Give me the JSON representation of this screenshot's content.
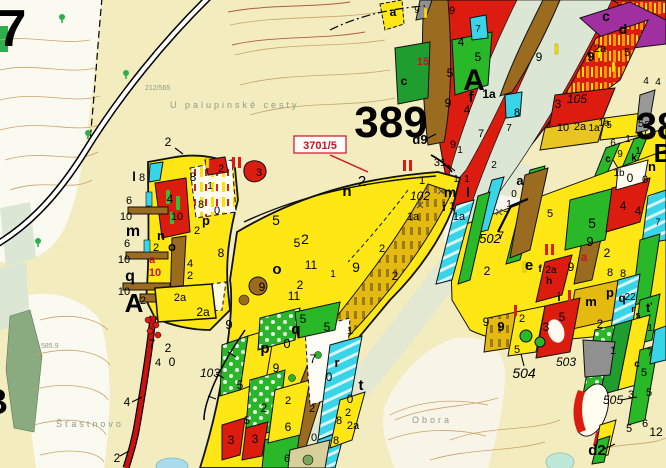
{
  "map": {
    "type": "forestry-stand-map",
    "palette": {
      "paper_cream": "#f2ecbe",
      "paper_white": "#fbfaf1",
      "stand_yellow": "#ffe715",
      "stand_gold": "#e5ba10",
      "stand_green": "#2ab52a",
      "stand_darkgreen": "#1f9e2f",
      "stand_red": "#dd1c10",
      "stand_brown": "#9b6c1f",
      "stand_cyan": "#38d4e8",
      "stand_purple": "#a02fa0",
      "stand_gray": "#909090",
      "meadow_band": "#dce6d4",
      "contour": "#c9a36a",
      "contour_index": "#b25b40",
      "label_red": "#cc1122",
      "label_gray": "#8d9c85"
    },
    "parcel_callout": {
      "text": "3701/5",
      "x": 294,
      "y": 136,
      "w": 52,
      "h": 17
    },
    "compartment_numbers": [
      "7",
      "389",
      "38"
    ],
    "stand_group_letters": [
      "A",
      "B"
    ],
    "place_names": [
      "U palupinské cesty",
      "Šťastnovo",
      "Obora"
    ],
    "road_numbers": [
      "102",
      "103",
      "105",
      "502",
      "503",
      "504",
      "505"
    ],
    "elevation_points": [
      "212/565",
      "585.9"
    ],
    "labels": [
      [
        "7",
        12,
        46,
        52,
        "b"
      ],
      [
        "389",
        391,
        137,
        44,
        "b"
      ],
      [
        "38",
        657,
        139,
        38,
        "b"
      ],
      [
        "B",
        663,
        162,
        26,
        "b"
      ],
      [
        "A",
        474,
        90,
        30,
        "b"
      ],
      [
        "f",
        471,
        102,
        15,
        "b"
      ],
      [
        "4",
        467,
        114,
        12,
        ""
      ],
      [
        "A",
        134,
        312,
        26,
        "b"
      ],
      [
        "B",
        -5,
        414,
        36,
        "b"
      ],
      [
        "a",
        393,
        16,
        12,
        "b"
      ],
      [
        "c",
        606,
        21,
        14,
        "b"
      ],
      [
        "d",
        623,
        34,
        14,
        "b"
      ],
      [
        "d9",
        420,
        144,
        13,
        "b"
      ],
      [
        "d2",
        597,
        455,
        15,
        "b"
      ],
      [
        "c",
        404,
        85,
        12,
        "b"
      ],
      [
        "15",
        423,
        65,
        11,
        "br"
      ],
      [
        "9",
        417,
        13,
        10,
        ""
      ],
      [
        "9",
        452,
        14,
        11,
        ""
      ],
      [
        "4",
        461,
        46,
        12,
        ""
      ],
      [
        "7",
        478,
        32,
        10,
        ""
      ],
      [
        "5",
        478,
        61,
        12,
        ""
      ],
      [
        "5",
        450,
        77,
        12,
        ""
      ],
      [
        "9",
        448,
        107,
        12,
        ""
      ],
      [
        "1a",
        489,
        98,
        12,
        "b"
      ],
      [
        "8",
        517,
        116,
        11,
        ""
      ],
      [
        "7",
        481,
        137,
        11,
        ""
      ],
      [
        "7",
        509,
        131,
        10,
        ""
      ],
      [
        "9",
        539,
        61,
        12,
        ""
      ],
      [
        "9",
        591,
        61,
        13,
        "b"
      ],
      [
        "3",
        558,
        108,
        12,
        ""
      ],
      [
        "105",
        577,
        103,
        12,
        "i"
      ],
      [
        "10",
        563,
        131,
        11,
        ""
      ],
      [
        "2a",
        580,
        130,
        11,
        ""
      ],
      [
        "1a",
        594,
        131,
        10,
        ""
      ],
      [
        "5",
        609,
        128,
        10,
        ""
      ],
      [
        "2a",
        600,
        52,
        11,
        ""
      ],
      [
        "5",
        627,
        56,
        11,
        ""
      ],
      [
        "5a",
        644,
        127,
        11,
        ""
      ],
      [
        "1a",
        604,
        126,
        10,
        ""
      ],
      [
        "4",
        646,
        84,
        10,
        ""
      ],
      [
        "4",
        658,
        85,
        10,
        ""
      ],
      [
        "1",
        628,
        142,
        10,
        ""
      ],
      [
        "6",
        613,
        146,
        10,
        ""
      ],
      [
        "1",
        638,
        154,
        10,
        ""
      ],
      [
        "9",
        620,
        157,
        10,
        ""
      ],
      [
        "k",
        634,
        161,
        10,
        "b"
      ],
      [
        "c",
        608,
        162,
        10,
        "b"
      ],
      [
        "1b",
        619,
        176,
        10,
        ""
      ],
      [
        "0",
        645,
        183,
        11,
        ""
      ],
      [
        "n",
        652,
        171,
        13,
        "b"
      ],
      [
        "0",
        630,
        182,
        12,
        ""
      ],
      [
        "7",
        658,
        225,
        9,
        ""
      ],
      [
        "l",
        134,
        181,
        13,
        "b"
      ],
      [
        "8",
        142,
        181,
        11,
        ""
      ],
      [
        "6",
        129,
        204,
        11,
        ""
      ],
      [
        "10",
        126,
        220,
        11,
        ""
      ],
      [
        "m",
        133,
        236,
        16,
        "b"
      ],
      [
        "6",
        127,
        247,
        11,
        ""
      ],
      [
        "10",
        124,
        263,
        11,
        ""
      ],
      [
        "q",
        130,
        281,
        16,
        "b"
      ],
      [
        "10",
        124,
        295,
        11,
        ""
      ],
      [
        "2",
        143,
        304,
        11,
        ""
      ],
      [
        "4",
        170,
        203,
        12,
        ""
      ],
      [
        "10",
        177,
        220,
        11,
        ""
      ],
      [
        "n",
        161,
        240,
        13,
        "b"
      ],
      [
        "2",
        156,
        251,
        11,
        ""
      ],
      [
        "o",
        172,
        251,
        13,
        "b"
      ],
      [
        "a",
        152,
        263,
        11,
        "br"
      ],
      [
        "10",
        155,
        276,
        11,
        "br"
      ],
      [
        "8",
        193,
        181,
        12,
        ""
      ],
      [
        "1",
        210,
        189,
        10,
        ""
      ],
      [
        "2",
        221,
        172,
        11,
        ""
      ],
      [
        "3",
        259,
        176,
        11,
        ""
      ],
      [
        "8",
        201,
        208,
        11,
        ""
      ],
      [
        "0",
        217,
        214,
        11,
        ""
      ],
      [
        "p",
        206,
        225,
        13,
        "b"
      ],
      [
        "2",
        197,
        234,
        11,
        ""
      ],
      [
        "8",
        221,
        257,
        12,
        ""
      ],
      [
        "4",
        190,
        267,
        11,
        ""
      ],
      [
        "2",
        190,
        279,
        11,
        ""
      ],
      [
        "2a",
        180,
        301,
        11,
        ""
      ],
      [
        "2a",
        203,
        316,
        12,
        ""
      ],
      [
        "2",
        168,
        146,
        12,
        ""
      ],
      [
        "n",
        347,
        196,
        15,
        "b"
      ],
      [
        "2",
        362,
        186,
        15,
        ""
      ],
      [
        "5",
        276,
        225,
        14,
        ""
      ],
      [
        "2",
        305,
        244,
        14,
        ""
      ],
      [
        "5",
        297,
        247,
        12,
        ""
      ],
      [
        "o",
        277,
        274,
        15,
        "b"
      ],
      [
        "11",
        311,
        269,
        12,
        ""
      ],
      [
        "9",
        356,
        272,
        14,
        ""
      ],
      [
        "1",
        333,
        277,
        10,
        ""
      ],
      [
        "2",
        300,
        289,
        12,
        ""
      ],
      [
        "11",
        294,
        300,
        12,
        ""
      ],
      [
        "9",
        262,
        291,
        12,
        ""
      ],
      [
        "2",
        382,
        252,
        11,
        ""
      ],
      [
        "2",
        395,
        280,
        12,
        ""
      ],
      [
        "1",
        422,
        184,
        11,
        ""
      ],
      [
        "102",
        420,
        200,
        12,
        "i"
      ],
      [
        "1a",
        413,
        220,
        11,
        ""
      ],
      [
        "1a",
        459,
        220,
        11,
        ""
      ],
      [
        "m",
        450,
        197,
        14,
        "b"
      ],
      [
        "l",
        468,
        197,
        14,
        "b"
      ],
      [
        "i",
        444,
        211,
        12,
        "b"
      ],
      [
        "1",
        452,
        209,
        10,
        ""
      ],
      [
        "1",
        456,
        182,
        10,
        ""
      ],
      [
        "1",
        467,
        182,
        10,
        ""
      ],
      [
        "9",
        453,
        148,
        11,
        ""
      ],
      [
        "1",
        460,
        153,
        10,
        ""
      ],
      [
        "31",
        440,
        166,
        11,
        ""
      ],
      [
        "2",
        494,
        168,
        10,
        ""
      ],
      [
        "a",
        520,
        185,
        13,
        "b"
      ],
      [
        "0",
        514,
        197,
        10,
        ""
      ],
      [
        "1",
        509,
        207,
        10,
        ""
      ],
      [
        "7",
        506,
        218,
        10,
        ""
      ],
      [
        "502",
        490,
        243,
        13,
        "i"
      ],
      [
        "7",
        501,
        239,
        11,
        ""
      ],
      [
        "2",
        487,
        275,
        12,
        ""
      ],
      [
        "9",
        486,
        326,
        12,
        ""
      ],
      [
        "5",
        517,
        353,
        11,
        ""
      ],
      [
        "e",
        529,
        270,
        15,
        "b"
      ],
      [
        "f",
        540,
        272,
        10,
        "b"
      ],
      [
        "2a",
        551,
        273,
        10,
        ""
      ],
      [
        "h",
        549,
        284,
        10,
        "b"
      ],
      [
        "a",
        584,
        261,
        12,
        "br"
      ],
      [
        "9",
        590,
        246,
        13,
        ""
      ],
      [
        "5",
        592,
        228,
        14,
        ""
      ],
      [
        "2",
        607,
        257,
        12,
        ""
      ],
      [
        "9",
        571,
        271,
        12,
        ""
      ],
      [
        "8",
        610,
        276,
        11,
        ""
      ],
      [
        "8",
        623,
        277,
        11,
        ""
      ],
      [
        "p",
        610,
        297,
        13,
        "b"
      ],
      [
        "q",
        622,
        302,
        12,
        "b"
      ],
      [
        "m",
        591,
        306,
        13,
        "b"
      ],
      [
        "22",
        630,
        300,
        10,
        ""
      ],
      [
        "i",
        559,
        301,
        12,
        "b"
      ],
      [
        "ť",
        649,
        312,
        13,
        "b"
      ],
      [
        "r",
        633,
        312,
        9,
        "b"
      ],
      [
        "s",
        638,
        318,
        9,
        "b"
      ],
      [
        "1",
        650,
        331,
        10,
        ""
      ],
      [
        "4",
        623,
        210,
        12,
        ""
      ],
      [
        "4",
        638,
        215,
        12,
        ""
      ],
      [
        "5",
        550,
        217,
        11,
        ""
      ],
      [
        "9",
        229,
        329,
        13,
        ""
      ],
      [
        "p",
        265,
        353,
        15,
        "b"
      ],
      [
        "0",
        287,
        348,
        13,
        ""
      ],
      [
        "q",
        296,
        334,
        15,
        "b"
      ],
      [
        "5",
        303,
        323,
        12,
        ""
      ],
      [
        "5",
        327,
        331,
        12,
        ""
      ],
      [
        "1",
        350,
        334,
        11,
        ""
      ],
      [
        "7",
        313,
        363,
        12,
        ""
      ],
      [
        "9",
        276,
        372,
        12,
        ""
      ],
      [
        "r",
        337,
        367,
        13,
        "b"
      ],
      [
        "0",
        329,
        381,
        12,
        ""
      ],
      [
        "t",
        361,
        390,
        15,
        "b"
      ],
      [
        "0",
        350,
        403,
        12,
        ""
      ],
      [
        "2",
        348,
        416,
        11,
        ""
      ],
      [
        "8",
        339,
        424,
        11,
        ""
      ],
      [
        "2a",
        353,
        429,
        11,
        ""
      ],
      [
        "8",
        336,
        444,
        11,
        ""
      ],
      [
        "0",
        314,
        441,
        11,
        ""
      ],
      [
        "2",
        288,
        404,
        11,
        ""
      ],
      [
        "2",
        312,
        412,
        11,
        ""
      ],
      [
        "5",
        240,
        389,
        12,
        ""
      ],
      [
        "2",
        264,
        412,
        12,
        ""
      ],
      [
        "5",
        247,
        424,
        11,
        ""
      ],
      [
        "3",
        231,
        444,
        12,
        ""
      ],
      [
        "3",
        255,
        443,
        12,
        ""
      ],
      [
        "6",
        288,
        431,
        12,
        ""
      ],
      [
        "6",
        287,
        462,
        11,
        ""
      ],
      [
        "103",
        210,
        377,
        12,
        "i"
      ],
      [
        "4",
        127,
        406,
        12,
        ""
      ],
      [
        "2",
        117,
        462,
        12,
        ""
      ],
      [
        "7",
        152,
        348,
        12,
        ""
      ],
      [
        "2",
        168,
        352,
        12,
        ""
      ],
      [
        "0",
        172,
        366,
        12,
        ""
      ],
      [
        "4",
        158,
        366,
        11,
        ""
      ],
      [
        "9",
        501,
        331,
        13,
        "b"
      ],
      [
        "3",
        546,
        331,
        12,
        ""
      ],
      [
        "5",
        562,
        321,
        12,
        ""
      ],
      [
        "2",
        600,
        328,
        12,
        ""
      ],
      [
        "2",
        522,
        322,
        11,
        ""
      ],
      [
        "504",
        524,
        378,
        14,
        "i"
      ],
      [
        "503",
        566,
        366,
        12,
        "i"
      ],
      [
        "505",
        613,
        404,
        12,
        "i"
      ],
      [
        "12",
        656,
        436,
        12,
        ""
      ],
      [
        "7",
        650,
        356,
        11,
        ""
      ],
      [
        "5",
        644,
        376,
        11,
        ""
      ],
      [
        "c",
        637,
        367,
        10,
        "b"
      ],
      [
        "5",
        649,
        396,
        11,
        ""
      ],
      [
        "3",
        631,
        398,
        11,
        ""
      ],
      [
        "6",
        645,
        427,
        11,
        ""
      ],
      [
        "5",
        629,
        432,
        11,
        ""
      ],
      [
        "1",
        613,
        354,
        11,
        ""
      ],
      [
        "585.9",
        41,
        348,
        7,
        "g"
      ],
      [
        "212/565",
        145,
        90,
        7,
        "g"
      ],
      [
        "U palupinské cesty",
        170,
        108,
        9,
        "G"
      ],
      [
        "Šťastnovo",
        56,
        427,
        9,
        "G"
      ],
      [
        "Obora",
        412,
        423,
        9,
        "G"
      ]
    ],
    "marks": {
      "red_bars": [
        [
          403,
          160
        ],
        [
          409,
          160
        ],
        [
          545,
          244
        ],
        [
          551,
          244
        ],
        [
          232,
          157
        ],
        [
          238,
          157
        ],
        [
          568,
          290
        ],
        [
          514,
          305
        ]
      ],
      "yellow_bars": [
        [
          424,
          8
        ],
        [
          612,
          62
        ],
        [
          555,
          44
        ],
        [
          206,
          158
        ],
        [
          523,
          262
        ],
        [
          598,
          48
        ]
      ],
      "x_marks": [
        [
          441,
          191
        ],
        [
          499,
          212
        ],
        [
          420,
          205
        ]
      ],
      "trees": [
        [
          126,
          76
        ],
        [
          88,
          136
        ],
        [
          38,
          244
        ],
        [
          62,
          20
        ]
      ],
      "red_dots": [
        [
          148,
          320
        ],
        [
          156,
          325
        ],
        [
          150,
          331
        ],
        [
          158,
          335
        ]
      ],
      "green_dots": [
        [
          318,
          355
        ],
        [
          292,
          378
        ]
      ]
    },
    "leaders": [
      [
        132,
        402,
        142,
        397
      ],
      [
        120,
        456,
        129,
        451
      ],
      [
        426,
        139,
        436,
        134
      ],
      [
        604,
        449,
        615,
        444
      ],
      [
        621,
        400,
        637,
        397
      ],
      [
        524,
        366,
        521,
        354
      ],
      [
        175,
        148,
        183,
        154
      ],
      [
        448,
        165,
        455,
        171
      ]
    ],
    "red_leader": [
      330,
      155,
      368,
      172
    ]
  }
}
